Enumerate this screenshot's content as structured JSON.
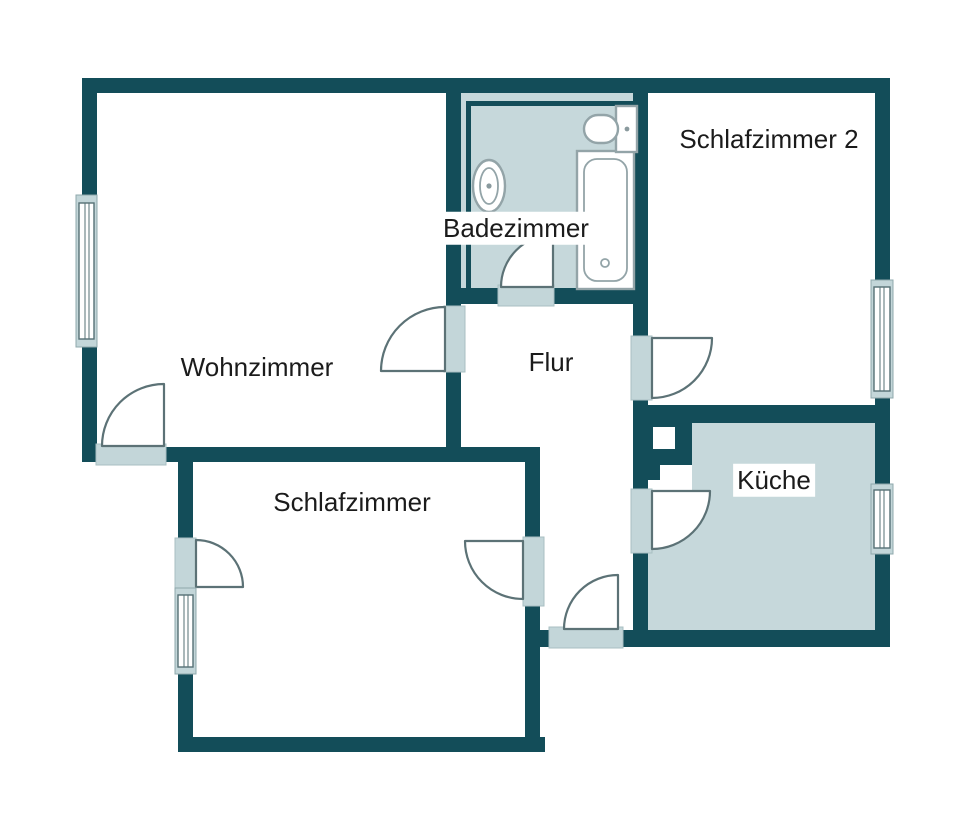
{
  "title": "Wohnung Grundriss",
  "rooms": {
    "wohnzimmer": {
      "label": "Wohnzimmer"
    },
    "badezimmer": {
      "label": "Badezimmer"
    },
    "schlafzimmer2": {
      "label": "Schlafzimmer 2"
    },
    "flur": {
      "label": "Flur"
    },
    "kueche": {
      "label": "Küche"
    },
    "schlafzimmer": {
      "label": "Schlafzimmer"
    }
  },
  "fixtures": [
    "bathtub",
    "sink",
    "toilet"
  ],
  "counts": {
    "doors": 8,
    "windows": 4
  },
  "colors": {
    "wall": "#134d59",
    "wet_room_fill": "#c6d8db",
    "threshold": "#c3d6d9",
    "door_arc": "#5c7276",
    "fixture_outline": "#93a4a8",
    "background": "#ffffff",
    "text": "#1b1b1b"
  }
}
